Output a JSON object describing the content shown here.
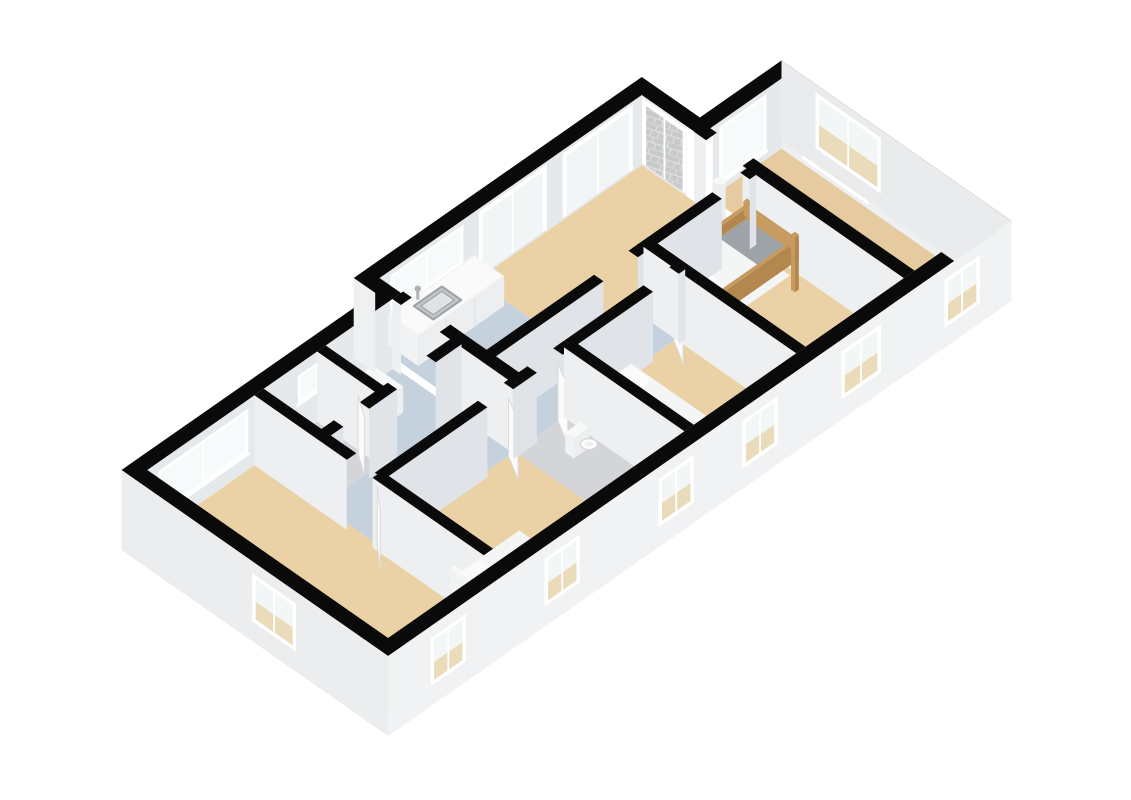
{
  "meta": {
    "description": "Isometric 3D dollhouse floor plan of an apartment, no visible text in image",
    "canvas": {
      "width": 1131,
      "height": 800,
      "background": "#FFFFFF"
    }
  },
  "scene": {
    "projection": {
      "ox": 100,
      "oy": 525,
      "K": 43,
      "J": 30,
      "wallTopZ": 70,
      "facadeBottomZ": -10
    },
    "palette": {
      "black": "#0a0a0a",
      "floor_beige": "#EAD2A6",
      "floor_beige_dim": "#E6CBA0",
      "floor_blue": "#C5D2DE",
      "floor_gray": "#D3D5D8",
      "face_u": "#E0E3E7",
      "face_v": "#EDEFF1",
      "face_back": "#E6E9EC",
      "facade_front": "#F1F2F3",
      "facade_left": "#EBEDEE",
      "facade_right": "#E9EBEC",
      "frame_white": "#FFFFFF",
      "glass_bright": "#F7FAFB",
      "glass_slider": "#F2F5F6",
      "glass_beige": "#EADCBA",
      "glass_top": "#F3F6F7",
      "tile_gray": "#C7C9CB",
      "tile_line": "#DEDFE0",
      "wood": "#C79B5F",
      "wood_dark": "#B3874E",
      "white_top": "#F7F8F8",
      "white_front": "#ECEEEF",
      "white_side": "#F1F2F3",
      "duvet": "#F4F5F5",
      "pillow": "#FBFBFC",
      "blanket_gray": "#9EA3A8",
      "bed_dark_top": "#54585C",
      "bed_dark_front": "#3E4246",
      "door_leaf": "#FBFBFB",
      "marble": "#F6F6F7",
      "sink_rim": "#9DA2A6",
      "sink_outer": "#C3C7CA",
      "sink_inner": "#E0E3E5",
      "metal": "#AEB3B7",
      "knob_dark": "#55585B"
    },
    "outline": {
      "outer": [
        [
          0,
          0.5
        ],
        [
          5.9,
          0.5
        ],
        [
          5.9,
          0
        ],
        [
          12.6,
          0
        ],
        [
          12.6,
          1.35
        ],
        [
          14.5,
          1.35
        ],
        [
          14.5,
          6.7
        ],
        [
          0,
          6.7
        ]
      ],
      "inner": [
        [
          0.3,
          0.8
        ],
        [
          6.2,
          0.8
        ],
        [
          6.2,
          0.3
        ],
        [
          12.3,
          0.3
        ],
        [
          12.3,
          1.65
        ],
        [
          14.2,
          1.65
        ],
        [
          14.2,
          6.4
        ],
        [
          0.3,
          6.4
        ]
      ]
    },
    "floors": [
      {
        "name": "bedroom-left",
        "color": "#EAD2A6",
        "poly": [
          [
            0.3,
            0.8
          ],
          [
            2.9,
            0.8
          ],
          [
            2.9,
            6.4
          ],
          [
            0.3,
            6.4
          ]
        ]
      },
      {
        "name": "bathroom",
        "color": "#D3D5D8",
        "poly": [
          [
            2.9,
            0.8
          ],
          [
            4.35,
            0.8
          ],
          [
            4.35,
            2.25
          ],
          [
            2.9,
            2.25
          ]
        ]
      },
      {
        "name": "closet",
        "color": "#C5D2DE",
        "poly": [
          [
            4.35,
            0.8
          ],
          [
            6.05,
            0.8
          ],
          [
            6.05,
            2.25
          ],
          [
            4.35,
            2.25
          ]
        ]
      },
      {
        "name": "hall",
        "color": "#C5D2DE",
        "poly": [
          [
            2.9,
            2.25
          ],
          [
            6.05,
            2.25
          ],
          [
            6.05,
            2.85
          ],
          [
            9.9,
            2.85
          ],
          [
            9.9,
            3.6
          ],
          [
            2.9,
            3.6
          ]
        ]
      },
      {
        "name": "bedroom-single",
        "color": "#EAD2A6",
        "poly": [
          [
            2.9,
            3.6
          ],
          [
            6.05,
            3.6
          ],
          [
            6.05,
            6.4
          ],
          [
            2.9,
            6.4
          ]
        ]
      },
      {
        "name": "kitchen",
        "color": "#C5D2DE",
        "poly": [
          [
            6.2,
            0.3
          ],
          [
            8.45,
            0.3
          ],
          [
            8.45,
            2.85
          ],
          [
            6.2,
            2.85
          ]
        ]
      },
      {
        "name": "living",
        "color": "#EAD2A6",
        "poly": [
          [
            8.45,
            0.3
          ],
          [
            12.3,
            0.3
          ],
          [
            12.3,
            2.85
          ],
          [
            8.45,
            2.85
          ]
        ]
      },
      {
        "name": "toilet",
        "color": "#D3D5D8",
        "poly": [
          [
            6.05,
            3.6
          ],
          [
            7.3,
            3.6
          ],
          [
            7.3,
            6.4
          ],
          [
            6.05,
            6.4
          ]
        ]
      },
      {
        "name": "bedroom-middle",
        "color": "#EAD2A6",
        "poly": [
          [
            7.3,
            3.6
          ],
          [
            9.9,
            3.6
          ],
          [
            9.9,
            6.4
          ],
          [
            7.3,
            6.4
          ]
        ]
      },
      {
        "name": "bunk-room",
        "color": "#EAD2A6",
        "poly": [
          [
            9.9,
            2.85
          ],
          [
            12.3,
            2.85
          ],
          [
            12.3,
            6.4
          ],
          [
            9.9,
            6.4
          ]
        ]
      },
      {
        "name": "room-right",
        "color": "#E6CBA0",
        "poly": [
          [
            12.55,
            1.65
          ],
          [
            14.2,
            1.65
          ],
          [
            14.2,
            6.4
          ],
          [
            12.55,
            6.4
          ]
        ]
      }
    ],
    "interiorFacades": [
      {
        "name": "back-wall-left",
        "axis": "u",
        "at": 0.8,
        "from": 0.3,
        "to": 6.2,
        "fill": "#E6E9EC",
        "windows": [
          {
            "type": "window",
            "a": 0.6,
            "b": 2.6,
            "z1": 20,
            "z2": 58
          },
          {
            "type": "window",
            "a": 3.85,
            "b": 4.25,
            "z1": 34,
            "z2": 56
          }
        ]
      },
      {
        "name": "back-wall-living",
        "axis": "u",
        "at": 0.3,
        "from": 6.2,
        "to": 12.3,
        "fill": "#E6E9EC",
        "windows": [
          {
            "type": "window",
            "a": 6.5,
            "b": 8.1,
            "z1": 30,
            "z2": 62
          },
          {
            "type": "slider",
            "a": 8.55,
            "b": 10.05,
            "z1": 0,
            "z2": 64
          },
          {
            "type": "slider",
            "a": 10.5,
            "b": 12.05,
            "z1": 0,
            "z2": 64
          }
        ]
      },
      {
        "name": "terrace-wall",
        "axis": "v",
        "at": 12.3,
        "from": 0.3,
        "to": 1.35,
        "fill": "#EDEFF1",
        "windows": [
          {
            "type": "slider-tiles",
            "a": 0.35,
            "b": 1.3,
            "z1": 0,
            "z2": 64
          }
        ]
      },
      {
        "name": "notch-front-wall",
        "axis": "u",
        "at": 1.65,
        "from": 12.6,
        "to": 14.2,
        "fill": "#E6E9EC",
        "windows": [
          {
            "type": "window",
            "a": 12.8,
            "b": 13.8,
            "z1": 12,
            "z2": 62
          }
        ]
      },
      {
        "name": "right-end-inner-wall",
        "axis": "v",
        "at": 14.2,
        "from": 1.65,
        "to": 6.4,
        "fill": "#EDEFF1",
        "windows": [
          {
            "type": "window",
            "a": 2.2,
            "b": 3.6,
            "z1": 10,
            "z2": 62
          }
        ]
      }
    ],
    "walls": [
      {
        "name": "bedroom-left-divider",
        "axis": "v",
        "c": 2.9,
        "from": 0.8,
        "to": 6.4,
        "t": 0.22,
        "openings": [
          [
            2.95,
            3.55
          ]
        ]
      },
      {
        "name": "bathroom-closet-divider",
        "axis": "v",
        "c": 4.35,
        "from": 0.8,
        "to": 2.25,
        "t": 0.2,
        "openings": []
      },
      {
        "name": "bathroom-closet-front",
        "axis": "u",
        "c": 2.25,
        "from": 2.9,
        "to": 6.05,
        "t": 0.22,
        "openings": [
          [
            3.3,
            3.9
          ],
          [
            4.55,
            5.45
          ]
        ]
      },
      {
        "name": "bedroom-single-back",
        "axis": "u",
        "c": 3.6,
        "from": 2.9,
        "to": 6.05,
        "t": 0.22,
        "openings": [
          [
            5.3,
            5.9
          ]
        ]
      },
      {
        "name": "hall-kitchen-wall",
        "axis": "v",
        "c": 6.125,
        "from": 0.8,
        "to": 3.6,
        "t": 0.25,
        "openings": [
          [
            1.0,
            1.9
          ]
        ]
      },
      {
        "name": "toilet-back",
        "axis": "u",
        "c": 3.6,
        "from": 6.05,
        "to": 7.3,
        "t": 0.22,
        "openings": [
          [
            6.45,
            7.05
          ]
        ]
      },
      {
        "name": "toilet-bedroom-divider",
        "axis": "v",
        "c": 7.3,
        "from": 3.6,
        "to": 6.4,
        "t": 0.22,
        "openings": []
      },
      {
        "name": "bedroom-middle-back",
        "axis": "u",
        "c": 3.6,
        "from": 7.3,
        "to": 9.9,
        "t": 0.22,
        "openings": [
          [
            9.15,
            9.75
          ]
        ]
      },
      {
        "name": "bedroom-bunk-divider",
        "axis": "v",
        "c": 9.9,
        "from": 2.85,
        "to": 6.4,
        "t": 0.22,
        "openings": []
      },
      {
        "name": "living-long-wall",
        "axis": "u",
        "c": 2.85,
        "from": 6.05,
        "to": 12.3,
        "t": 0.22,
        "openings": [
          [
            8.75,
            9.55
          ],
          [
            11.5,
            12.15
          ]
        ]
      },
      {
        "name": "right-room-divider",
        "axis": "v",
        "c": 12.42,
        "from": 1.52,
        "to": 6.4,
        "t": 0.25,
        "openings": [
          [
            1.8,
            2.65
          ]
        ]
      }
    ],
    "exteriorFacades": [
      {
        "name": "facade-step",
        "axis": "v",
        "at": 5.9,
        "from": 0,
        "to": 0.5,
        "fill": "#EFF0F1",
        "windows": []
      },
      {
        "name": "facade-left-end",
        "axis": "v",
        "at": 0,
        "from": 0.5,
        "to": 6.7,
        "fill": "#EBEDEE",
        "windows": [
          {
            "a": 3.6,
            "b": 4.5,
            "z1": 14,
            "z2": 54
          }
        ]
      },
      {
        "name": "facade-right-end",
        "axis": "v",
        "at": 14.5,
        "from": 1.35,
        "to": 6.7,
        "fill": "#E9EBEC",
        "flip": true,
        "windows": [
          {
            "a": 2.2,
            "b": 3.6,
            "z1": 10,
            "z2": 58
          }
        ]
      },
      {
        "name": "facade-front",
        "axis": "u",
        "at": 6.7,
        "from": 0,
        "to": 14.5,
        "fill": "#F1F2F3",
        "windows": [
          {
            "a": 1.05,
            "b": 1.75,
            "z1": 14,
            "z2": 54
          },
          {
            "a": 3.7,
            "b": 4.4,
            "z1": 14,
            "z2": 54
          },
          {
            "a": 6.35,
            "b": 7.05,
            "z1": 14,
            "z2": 54
          },
          {
            "a": 8.3,
            "b": 9.0,
            "z1": 14,
            "z2": 54
          },
          {
            "a": 10.6,
            "b": 11.4,
            "z1": 14,
            "z2": 54
          },
          {
            "a": 13.0,
            "b": 13.7,
            "z1": 14,
            "z2": 54
          }
        ]
      }
    ],
    "furniture": [
      {
        "type": "counter",
        "name": "kitchen-counter",
        "u1": 6.35,
        "u2": 8.35,
        "v1": 0.35,
        "v2": 1.05,
        "h": 30
      },
      {
        "type": "washer",
        "name": "washing-machine",
        "u1": 4.7,
        "u2": 5.4,
        "v1": 0.95,
        "v2": 1.65,
        "h": 26
      },
      {
        "type": "bunkbed",
        "name": "bunk-bed",
        "u1": 10.05,
        "u2": 12.05,
        "v1": 3.0,
        "v2": 4.2
      },
      {
        "type": "bed",
        "name": "double-bed",
        "u1": 7.45,
        "u2": 8.6,
        "v1": 3.75,
        "v2": 5.85,
        "pillows": 2,
        "darkFoot": true
      },
      {
        "type": "bedSingle",
        "name": "single-bed",
        "u1": 3.05,
        "u2": 4.55,
        "v1": 5.2,
        "v2": 6.15
      },
      {
        "type": "toilet",
        "name": "wall-basin",
        "u": 6.8,
        "v": 4.45
      },
      {
        "type": "pillar",
        "name": "column",
        "u": 11.9,
        "v": 2.5,
        "h": 62
      }
    ],
    "doorLeaves": [
      {
        "name": "door-bedroom-left",
        "a": [
          2.9,
          3.55
        ],
        "b": [
          2.52,
          4.0
        ]
      },
      {
        "name": "door-bathroom",
        "a": [
          3.9,
          2.25
        ],
        "b": [
          4.2,
          1.8
        ]
      },
      {
        "name": "door-bedroom-single",
        "a": [
          5.9,
          3.6
        ],
        "b": [
          5.62,
          4.1
        ]
      },
      {
        "name": "door-toilet",
        "a": [
          7.05,
          3.6
        ],
        "b": [
          6.78,
          4.1
        ]
      },
      {
        "name": "door-bedroom-middle",
        "a": [
          9.75,
          3.6
        ],
        "b": [
          9.46,
          4.1
        ]
      },
      {
        "name": "door-bunk-room",
        "a": [
          12.15,
          2.85
        ],
        "b": [
          11.88,
          3.35
        ]
      },
      {
        "name": "door-room-right",
        "a": [
          12.54,
          2.65
        ],
        "b": [
          12.72,
          3.18
        ]
      }
    ]
  }
}
